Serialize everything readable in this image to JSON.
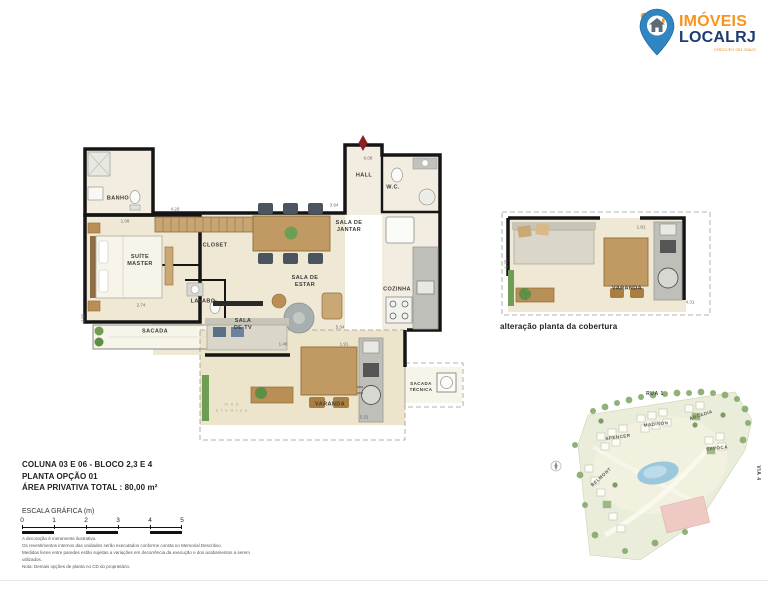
{
  "logo": {
    "name_line1": "IMÓVEIS",
    "name_line2": "LOCALRJ",
    "creci": "CRECI/RJ 051.306/O"
  },
  "plan": {
    "rooms": {
      "banho": "BANHO",
      "suite_line1": "SUÍTE",
      "suite_line2": "MASTER",
      "closet": "CLOSET",
      "lavabo": "LAVABO",
      "sacada": "SACADA",
      "sala_tv_line1": "SALA",
      "sala_tv_line2": "DE TV",
      "sala_estar_line1": "SALA DE",
      "sala_estar_line2": "ESTAR",
      "sala_jantar_line1": "SALA DE",
      "sala_jantar_line2": "JANTAR",
      "hall": "HALL",
      "wc": "W.C.",
      "cozinha": "COZINHA",
      "varanda": "VARANDA",
      "sacada_tecnica_line1": "SACADA",
      "sacada_tecnica_line2": "TÉCNICA"
    },
    "dims": [
      "6.08",
      "3.94",
      "4.29",
      "2.74",
      "2.66",
      "5.34",
      "1.48",
      "1.91",
      "5.31",
      "1.08"
    ],
    "watermark_line1": "m h b",
    "watermark_line2": "s t u d i o s"
  },
  "cobertura": {
    "varanda": "VARANDA",
    "caption": "alteração planta da cobertura",
    "dims": [
      "1.76",
      "1.81",
      "4.31"
    ],
    "watermark_line1": "m h b",
    "watermark_line2": "s t u d i o s"
  },
  "info": {
    "line1": "COLUNA  03 E 06 - BLOCO 2,3 E 4",
    "line2": "PLANTA OPÇÃO 01",
    "line3": "ÁREA PRIVATIVA TOTAL :  80,00 m²",
    "scale_label": "ESCALA GRÁFICA (m)",
    "scale_ticks": [
      "0",
      "1",
      "2",
      "3",
      "4",
      "5"
    ]
  },
  "disclaimer": {
    "line1": "A decoração é meramente ilustrativa.",
    "line2": "Os revestimentos internos das unidades serão executados conforme consta no Memorial Descritivo.",
    "line3": "Medidas livres entre paredes estão sujeitas a variações em decorrência da execução e dos acabamentos a serem utilizados.",
    "line4": "Nota: Demais opções de planta no CD do proprietário."
  },
  "sitemap": {
    "rua": "RUA 1",
    "via": "VIA 4",
    "buildings": [
      "SPENCER",
      "MADISON",
      "ARCADIA",
      "SAVOCA",
      "BELMONT"
    ]
  },
  "colors": {
    "logo_orange": "#F7941E",
    "logo_navy": "#1C3C70",
    "pin_blue": "#2F86C2",
    "wall_black": "#151515",
    "floor_cream": "#EFE8D5",
    "wood": "#C09A62",
    "north_red": "#8E1F1F"
  }
}
